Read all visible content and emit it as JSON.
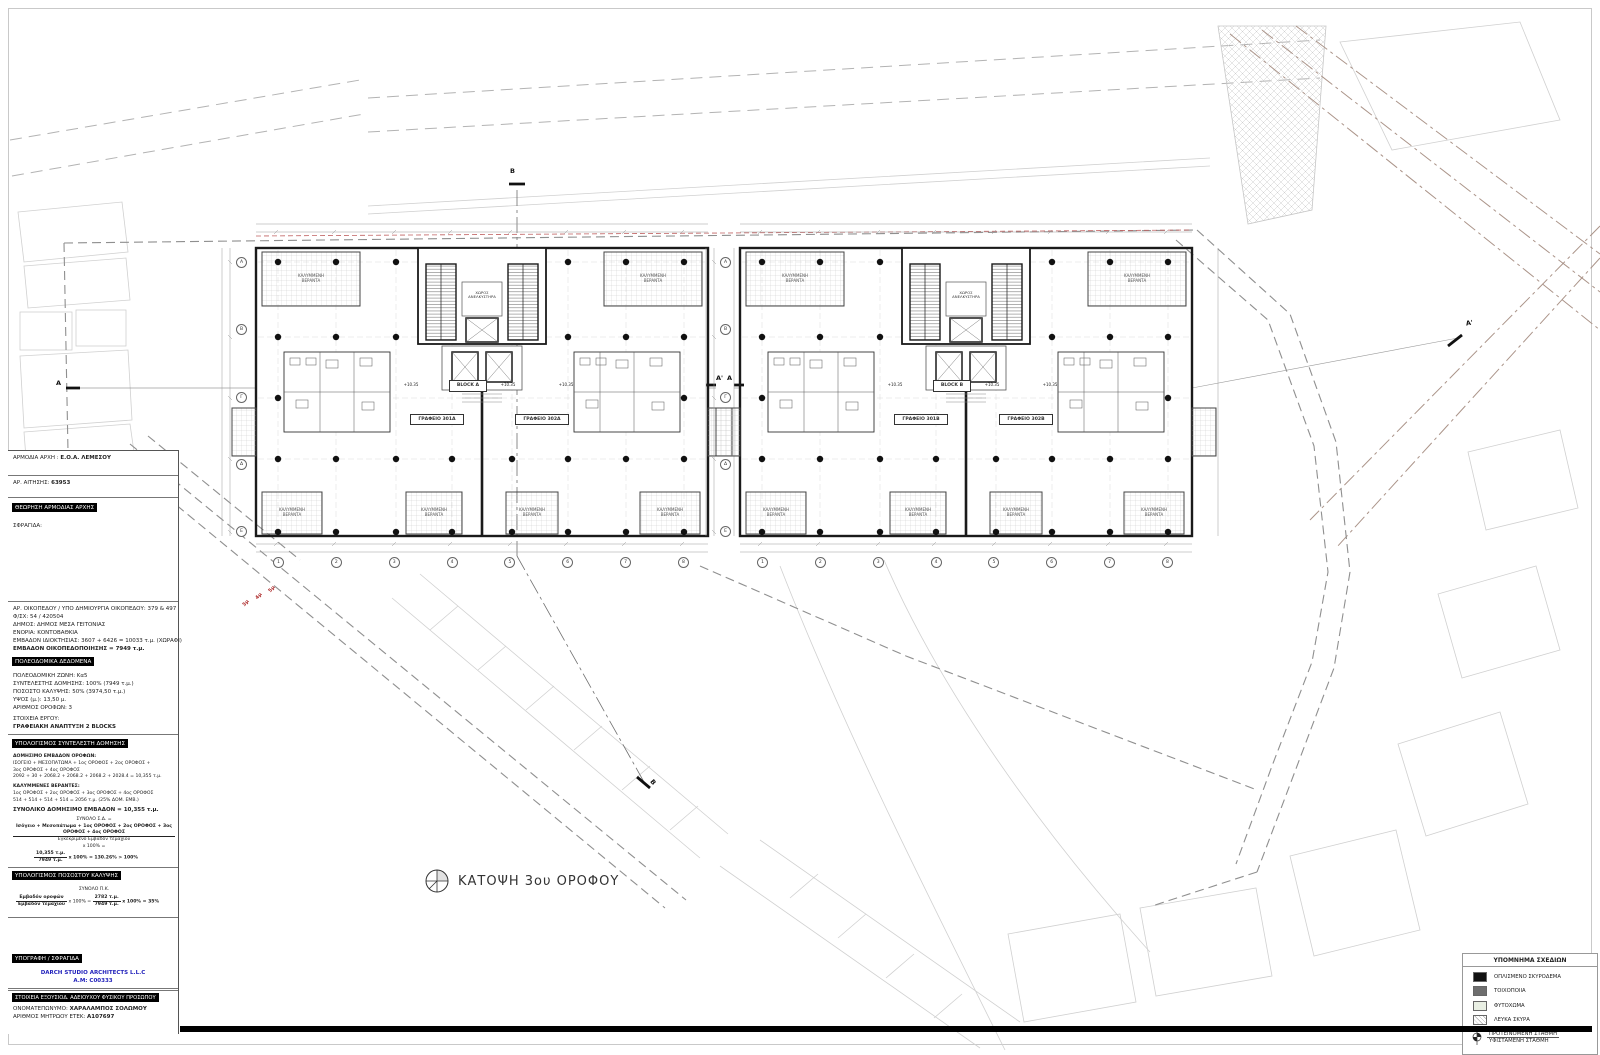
{
  "colors": {
    "accent_blue": "#2222bb",
    "red_annotation": "#b03030",
    "legend_concrete": "#111111",
    "legend_masonry": "#6e6e6e",
    "legend_soil": "#e9efe3"
  },
  "title_block": {
    "authority_label": "ΑΡΜΟΔΙΑ ΑΡΧΗ :",
    "authority": "Ε.Ο.Α. ΛΕΜΕΣΟΥ",
    "application_label": "ΑΡ. ΑΙΤΗΣΗΣ:",
    "application_no": "63953",
    "approval_header": "ΘΕΩΡΗΣΗ ΑΡΜΟΔΙΑΣ ΑΡΧΗΣ",
    "stamp_label": "ΣΦΡΑΓΙΔΑ:",
    "plot_lines": [
      "ΑΡ. ΟΙΚΟΠΕΔΟΥ / ΥΠΟ ΔΗΜΙΟΥΡΓΙΑ ΟΙΚΟΠΕΔΟΥ: 379 & 497",
      "Φ/ΣΧ: 54 / 420504",
      "ΔΗΜΟΣ: ΔΗΜΟΣ ΜΕΣΑ ΓΕΙΤΟΝΙΑΣ",
      "ΕΝΟΡΙΑ: ΚΟΝΤΟΒΑΘΚΙΑ",
      "ΕΜΒΑΔΟΝ ΙΔΙΟΚΤΗΣΙΑΣ: 3607 + 6426 = 10033 τ.μ. (ΧΩΡΑΦΙ)",
      "ΕΜΒΑΔΟΝ ΟΙΚΟΠΕΔΟΠΟΙΗΣΗΣ = 7949 τ.μ."
    ],
    "zoning_header": "ΠΟΛΕΟΔΟΜΙΚΑ ΔΕΔΟΜΕΝΑ",
    "zoning_lines": [
      "ΠΟΛΕΟΔΟΜΙΚΗ ΖΩΝΗ: Κα5",
      "ΣΥΝΤΕΛΕΣΤΗΣ ΔΟΜΗΣΗΣ: 100% (7949 τ.μ.)",
      "ΠΟΣΟΣΤΟ ΚΑΛΥΨΗΣ: 50% (3974,50 τ.μ.)",
      "ΥΨΟΣ (μ.): 13,50 μ.",
      "ΑΡΙΘΜΟΣ ΟΡΟΦΩΝ: 3"
    ],
    "project_label": "ΣΤΟΙΧΕΙΑ ΕΡΓΟΥ:",
    "project_name": "ΓΡΑΦΕΙΑΚΗ ΑΝΑΠΤΥΞΗ 2 BLOCKS",
    "far_header": "ΥΠΟΛΟΓΙΣΜΟΣ ΣΥΝΤΕΛΕΣΤΗ ΔΟΜΗΣΗΣ",
    "far_sub1": "ΔΟΜΗΣΙΜΟ ΕΜΒΑΔΟΝ ΟΡΟΦΩΝ:",
    "far_l1": "ΙΣΟΓΕΙΟ + ΜΕΣΟΠΑΤΩΜΑ + 1ος ΟΡΟΦΟΣ + 2ος ΟΡΟΦΟΣ +",
    "far_l2": "3ος ΟΡΟΦΟΣ + 4ος ΟΡΟΦΟΣ",
    "far_l3": "2092 + 30 + 2068.2 + 2068.2 + 2068.2 + 2028.4 = 10,355 τ.μ.",
    "ver_sub": "ΚΑΛΥΜΜΕΝΕΣ ΒΕΡΑΝΤΕΣ:",
    "ver_l1": "1ος ΟΡΟΦΟΣ + 2ος ΟΡΟΦΟΣ + 3ος ΟΡΟΦΟΣ + 4ος ΟΡΟΦΟΣ",
    "ver_l2": "514 + 514 + 514 + 514 = 2056 τ.μ. (25% ΔΟΜ. ΕΜΒ.)",
    "total_line": "ΣΥΝΟΛΙΚΟ ΔΟΜΗΣΙΜΟ ΕΜΒΑΔΟΝ = 10,355 τ.μ.",
    "sd_line": "ΣΥΝΟΛΟ Σ.Δ. =",
    "frac1_num": "Ισόγειο + Μεσοπάτωμα + 1ος ΟΡΟΦΟΣ + 2ος ΟΡΟΦΟΣ + 3ος ΟΡΟΦΟΣ + 4ος ΟΡΟΦΟΣ",
    "frac1_den": "Εγκεκριμένο Εμβαδόν τεμαχίου",
    "frac1_eq": "x 100% =",
    "frac2_num": "10,355 τ.μ.",
    "frac2_den": "7949 τ.μ.",
    "frac2_rest": "x 100% = 130.26% > 100%",
    "coverage_header": "ΥΠΟΛΟΓΙΣΜΟΣ ΠΟΣΟΣΤΟΥ ΚΑΛΥΨΗΣ",
    "cov_total": "ΣΥΝΟΛΟ Π.Κ.",
    "cov_num": "Εμβαδόν οροφών",
    "cov_den": "Εμβαδόν τεμαχίου",
    "cov_mid": "x 100% =",
    "cov_num2": "2782 τ.μ.",
    "cov_den2": "7949 τ.μ.",
    "cov_rest": "x 100% = 35%",
    "signature_header": "ΥΠΟΓΡΑΦΗ / ΣΦΡΑΓΙΔΑ",
    "architect": "DARCH STUDIO ARCHITECTS L.L.C",
    "architect_reg": "A.M: C00333",
    "licensee_header": "ΣΤΟΙΧΕΙΑ ΕΞΟΥΣΙΟΔ. ΑΔΕΙΟΥΧΟΥ ΦΥΣΙΚΟΥ ΠΡΟΣΩΠΟΥ",
    "licensee_name_label": "ΟΝΟΜΑΤΕΠΩΝΥΜΟ:",
    "licensee_name": "ΧΑΡΑΛΑΜΠΟΣ ΣΟΛΩΜΟΥ",
    "licensee_reg_label": "ΑΡΙΘΜΟΣ ΜΗΤΡΩΟΥ ΕΤΕΚ:",
    "licensee_reg": "Α107697"
  },
  "plan": {
    "drawing_title": "ΚΑΤΟΨΗ 3ου ΟΡΟΦΟΥ",
    "blocks": [
      {
        "name": "BLOCK A",
        "office_left": "ΓΡΑΦΕΙΟ 301Α",
        "office_right": "ΓΡΑΦΕΙΟ 302Α"
      },
      {
        "name": "BLOCK B",
        "office_left": "ΓΡΑΦΕΙΟ 301Β",
        "office_right": "ΓΡΑΦΕΙΟ 302Β"
      }
    ],
    "veranda_label_1": "ΚΑΛΥΜΜΕΝΗ",
    "veranda_label_2": "ΒΕΡΑΝΤΑ",
    "lift_label_1": "ΧΩΡΟΣ",
    "lift_label_2": "ΑΝΕΛΚΥΣΤΗΡΑ",
    "level_mark": "+10.35",
    "grid_cols": [
      "1",
      "2",
      "3",
      "4",
      "5",
      "6",
      "7",
      "8"
    ],
    "grid_rows": [
      "Α",
      "Β",
      "Γ",
      "Δ",
      "Ε"
    ],
    "section_a": "A",
    "section_a_prime": "A'",
    "section_b": "B",
    "setbacks": [
      "3μ",
      "4μ",
      "5μ"
    ]
  },
  "legend": {
    "header": "ΥΠΟΜΝΗΜΑ ΣΧΕΔΙΩΝ",
    "items": [
      {
        "label": "ΟΠΛΙΣΜΕΝΟ ΣΚΥΡΟΔΕΜΑ"
      },
      {
        "label": "ΤΟΙΧΟΠΟΙΙΑ"
      },
      {
        "label": "ΦΥΤΟΧΩΜΑ"
      },
      {
        "label": "ΛΕΥΚΑ ΣΚΥΡΑ"
      }
    ],
    "level_proposed": "ΠΡΟΤΕΙΝΟΜΕΝΗ ΣΤΑΘΜΗ",
    "level_existing": "ΥΦΙΣΤΑΜΕΝΗ ΣΤΑΘΜΗ"
  }
}
